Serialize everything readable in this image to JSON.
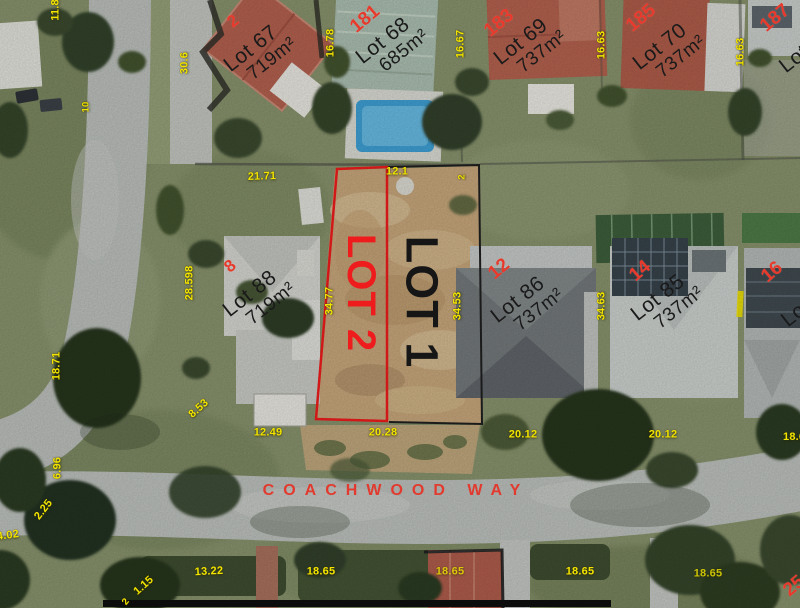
{
  "street_label": "COACHWOOD WAY",
  "primary_lots": {
    "lot2": "LOT 2",
    "lot1": "LOT 1"
  },
  "lot_labels": [
    {
      "name": "Lot 67",
      "area": "719m²"
    },
    {
      "name": "Lot 68",
      "area": "685m²"
    },
    {
      "name": "Lot 69",
      "area": "737m²"
    },
    {
      "name": "Lot 70",
      "area": "737m²"
    },
    {
      "name": "Lot 88",
      "area": "719m²"
    },
    {
      "name": "Lot 86",
      "area": "737m²"
    },
    {
      "name": "Lot 85",
      "area": "737m²"
    }
  ],
  "partial_lot_labels": [
    {
      "name": "Lot"
    },
    {
      "name": "Lot"
    }
  ],
  "house_numbers": [
    "2",
    "181",
    "183",
    "185",
    "187",
    "8",
    "12",
    "14",
    "16",
    "25"
  ],
  "dimensions": [
    "11.8",
    "10",
    "30.6",
    "16.78",
    "16.67",
    "16.63",
    "16.63",
    "21.71",
    "12.1",
    "2",
    "28.598",
    "34.77",
    "34.53",
    "34.63",
    "18.71",
    "8.53",
    "12.49",
    "20.28",
    "20.12",
    "20.12",
    "18.65",
    "6.96",
    "2.25",
    "4.02",
    "1.15",
    "13.22",
    "18.65",
    "18.65",
    "18.65",
    "18.65",
    "2"
  ],
  "colors": {
    "dimension_text": "#f2e400",
    "annotation_red": "#e73a2c",
    "parcel2_outline": "#ee1c1c",
    "parcel1_outline": "#1f1f1f",
    "lot_text": "#1a1a1a"
  }
}
